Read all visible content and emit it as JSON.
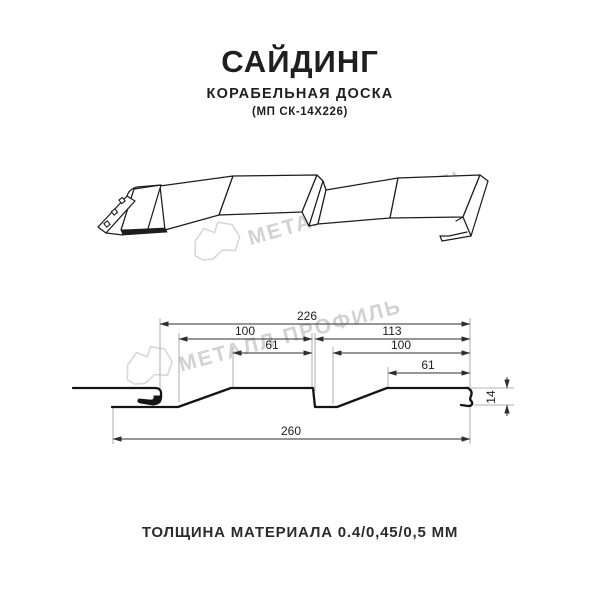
{
  "header": {
    "title": "САЙДИНГ",
    "subtitle": "КОРАБЕЛЬНАЯ ДОСКА",
    "product_code": "(МП СК-14Х226)"
  },
  "watermark": {
    "brand_name": "МЕТАЛЛ ПРОФИЛЬ",
    "color": "#d2d2d2"
  },
  "drawing": {
    "type": "siding-profile-cross-section",
    "labels": {
      "span_226": "226",
      "left_100": "100",
      "left_61": "61",
      "right_113": "113",
      "right_100": "100",
      "right_61": "61",
      "overall_260": "260",
      "height_14": "14"
    },
    "dimensions_mm": {
      "overall_width": 260,
      "profile_span": 226,
      "left_board_width": 100,
      "left_board_flat": 61,
      "right_board_span": 113,
      "right_board_width": 100,
      "right_board_flat": 61,
      "profile_height": 14
    },
    "line_color": "#141414",
    "dim_color": "#2e2e2e"
  },
  "footer": {
    "material_note": "ТОЛЩИНА МАТЕРИАЛА 0.4/0,45/0,5 ММ"
  }
}
